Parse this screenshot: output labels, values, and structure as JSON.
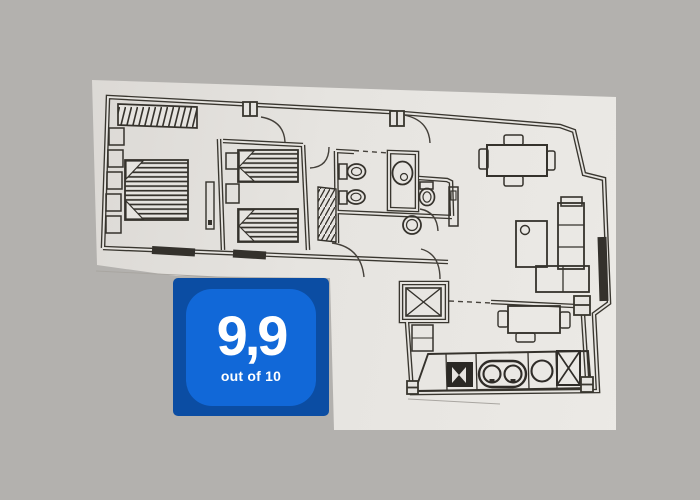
{
  "background_color": "#b3b1ae",
  "paper_color": "#e6e4e0",
  "line_color": "#39362f",
  "badge": {
    "score": "9,9",
    "caption": "out of 10",
    "outer_color": "#0b4da3",
    "inner_color": "#1168d8",
    "text_color": "#ffffff"
  },
  "floor_plan": {
    "type": "apartment-floor-plan-scan",
    "rooms": [
      "master-bedroom",
      "second-bedroom",
      "entry-hall",
      "bathroom",
      "wc",
      "living-dining-room",
      "kitchen"
    ],
    "furniture": [
      "wardrobe",
      "closet-units",
      "double-bed",
      "nightstands",
      "twin-bed-1",
      "twin-bed-2",
      "toilet",
      "bidet",
      "shower",
      "wc-toilet",
      "wash-basin",
      "sink-panel",
      "dining-table-with-chairs",
      "coffee-table",
      "corner-sofa",
      "kitchen-table-with-chairs",
      "stove",
      "double-sink",
      "burner",
      "fridge",
      "service-shaft",
      "windows",
      "doors"
    ]
  }
}
